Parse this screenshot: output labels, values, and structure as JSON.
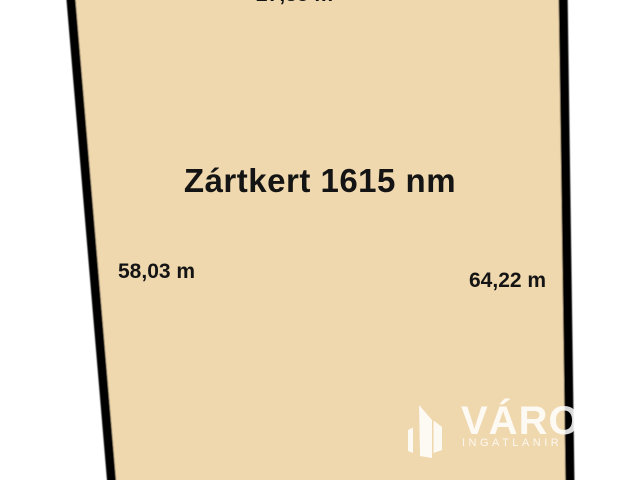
{
  "plot": {
    "title": "Zártkert 1615 nm",
    "dimensions": {
      "top": "27,85 m",
      "left": "58,03 m",
      "right": "64,22 m"
    },
    "fill_color": "#f0d8ae",
    "border_color": "#000000",
    "text_color": "#141414"
  },
  "watermark": {
    "brand": "VÁRO",
    "subtitle": "INGATLANIR",
    "icon": "buildings-icon",
    "color": "#ffffff"
  }
}
